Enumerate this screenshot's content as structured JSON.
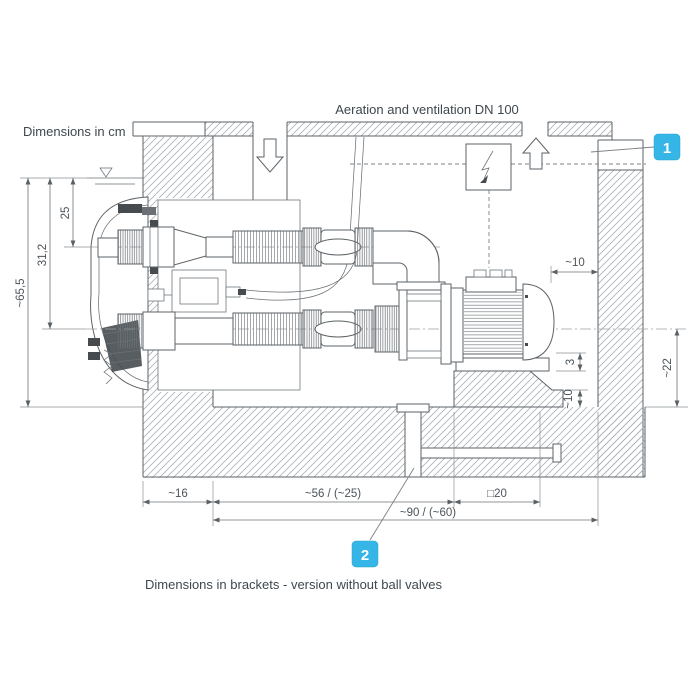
{
  "labels": {
    "dimensions_unit_note": "Dimensions in cm",
    "aeration_label": "Aeration and ventilation DN 100",
    "footer_note": "Dimensions in brackets - version without ball valves"
  },
  "callouts": {
    "one": "1",
    "two": "2"
  },
  "dimensions": {
    "water_to_nozzle_axis": "25",
    "water_to_suction_axis": "31,2",
    "water_to_floor": "~65,5",
    "motor_to_wall": "~10",
    "foot_gap": "3",
    "plinth_step": "~10",
    "axis_to_floor": "~22",
    "pool_wall_thickness": "~16",
    "wall_to_plinth": "~56 / (~25)",
    "plinth_square": "□20",
    "wall_to_right_wall": "~90 / (~60)"
  },
  "colors": {
    "accent": "#35b6e6",
    "line": "#5d6367",
    "text": "#3d484f"
  }
}
